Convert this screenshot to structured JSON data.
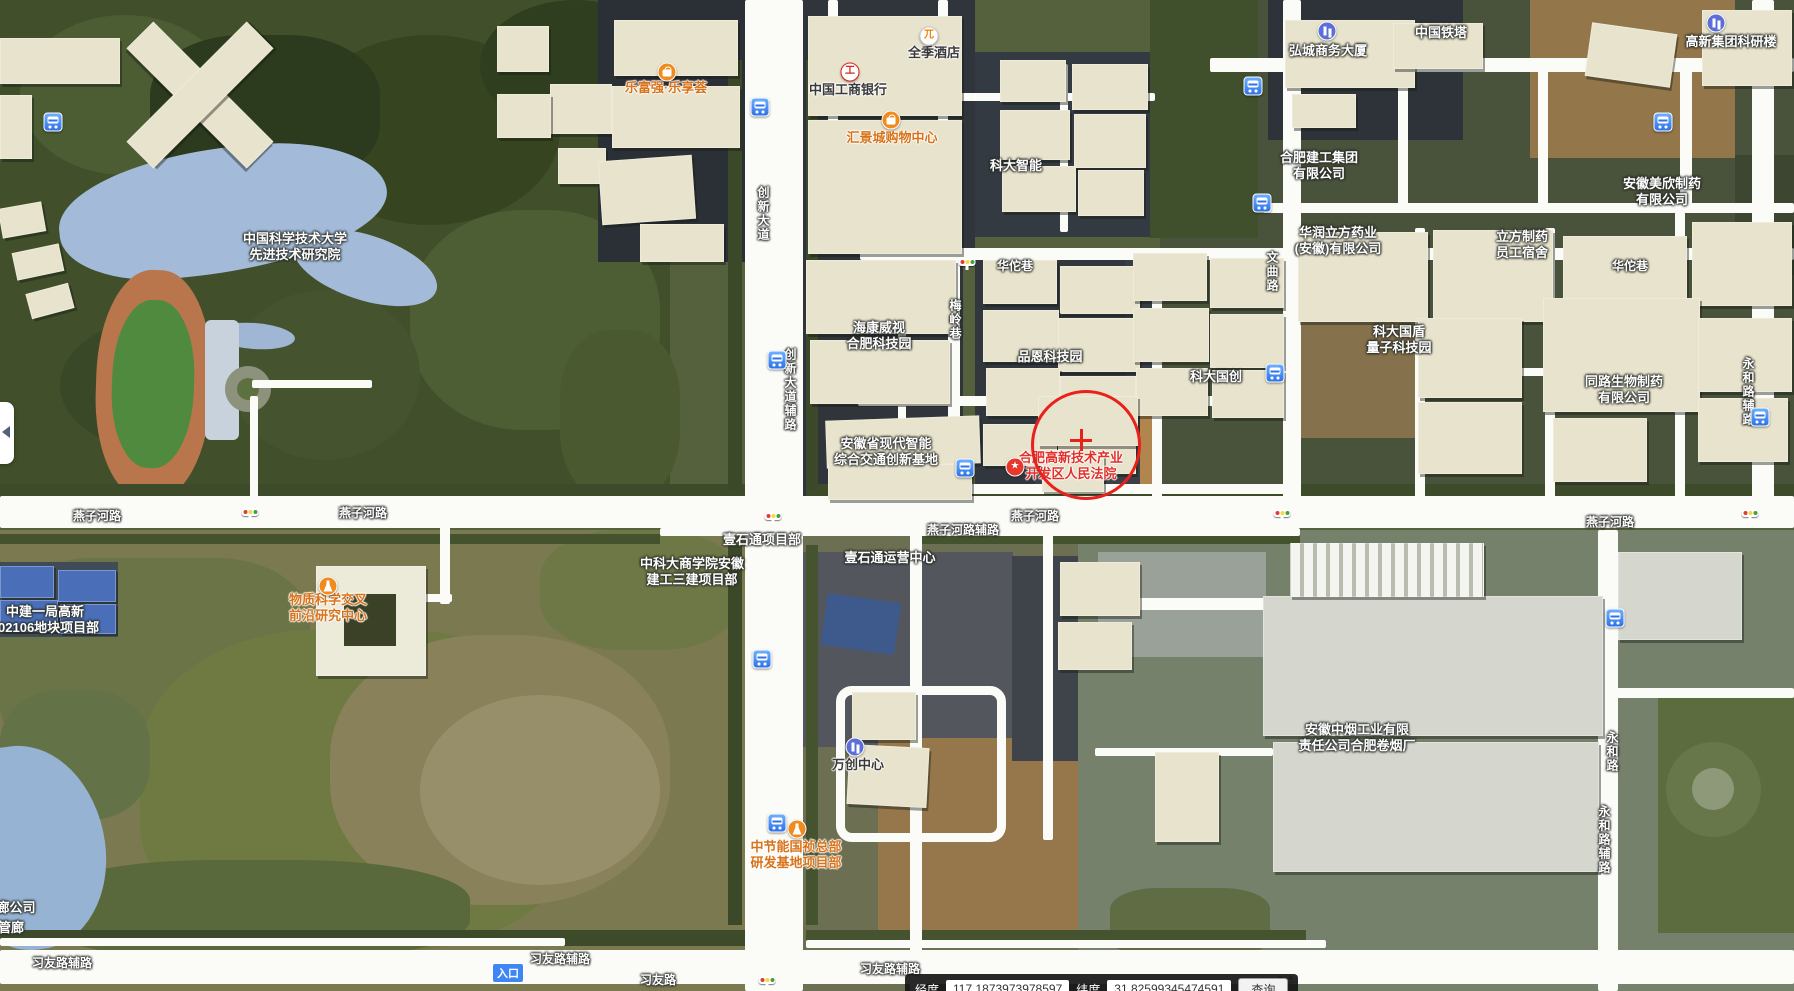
{
  "map": {
    "colors": {
      "poi_orange": "#d9731a",
      "poi_red": "#e0312b",
      "poi_dark": "#3a3a3a",
      "road_label_white": "#ffffff",
      "marker_red": "#e8211a",
      "entrance_blue": "#3f86f5"
    },
    "road_labels": [
      {
        "text": "燕子河路",
        "x": 97,
        "y": 516,
        "vertical": false
      },
      {
        "text": "燕子河路",
        "x": 363,
        "y": 513,
        "vertical": false
      },
      {
        "text": "燕子河路",
        "x": 1035,
        "y": 516,
        "vertical": false
      },
      {
        "text": "燕子河路",
        "x": 1610,
        "y": 522,
        "vertical": false
      },
      {
        "text": "燕子河路辅路",
        "x": 963,
        "y": 530,
        "vertical": false
      },
      {
        "text": "习友路辅路",
        "x": 62,
        "y": 963,
        "vertical": false
      },
      {
        "text": "习友路辅路",
        "x": 560,
        "y": 959,
        "vertical": false
      },
      {
        "text": "习友路辅路",
        "x": 890,
        "y": 969,
        "vertical": false
      },
      {
        "text": "习友路",
        "x": 658,
        "y": 980,
        "vertical": false
      },
      {
        "text": "创新大道",
        "x": 763,
        "y": 214,
        "vertical": true
      },
      {
        "text": "创新大道辅路",
        "x": 790,
        "y": 390,
        "vertical": true
      },
      {
        "text": "华佗巷",
        "x": 1015,
        "y": 266,
        "vertical": false
      },
      {
        "text": "华佗巷",
        "x": 1630,
        "y": 266,
        "vertical": false
      },
      {
        "text": "梅岭巷",
        "x": 955,
        "y": 320,
        "vertical": true
      },
      {
        "text": "文曲路",
        "x": 1272,
        "y": 272,
        "vertical": true
      },
      {
        "text": "永和路辅路",
        "x": 1748,
        "y": 392,
        "vertical": true
      },
      {
        "text": "永和路",
        "x": 1612,
        "y": 752,
        "vertical": true
      },
      {
        "text": "永和路辅路",
        "x": 1604,
        "y": 840,
        "vertical": true
      }
    ],
    "poi_labels": [
      {
        "lines": [
          "中国科学技术大学",
          "先进技术研究院"
        ],
        "x": 295,
        "y": 247,
        "color": "white"
      },
      {
        "lines": [
          "乐富强·乐享荟"
        ],
        "x": 666,
        "y": 88,
        "color": "orange",
        "icon": "bag",
        "icon_x": 667,
        "icon_y": 72
      },
      {
        "lines": [
          "中国工商银行"
        ],
        "x": 848,
        "y": 90,
        "color": "dark",
        "icon": "icbc",
        "icon_x": 850,
        "icon_y": 72
      },
      {
        "lines": [
          "全季酒店"
        ],
        "x": 934,
        "y": 53,
        "color": "dark",
        "icon": "hotel",
        "icon_x": 929,
        "icon_y": 36
      },
      {
        "lines": [
          "汇景城购物中心"
        ],
        "x": 892,
        "y": 138,
        "color": "orange",
        "icon": "bag",
        "icon_x": 891,
        "icon_y": 120
      },
      {
        "lines": [
          "科大智能"
        ],
        "x": 1016,
        "y": 166,
        "color": "white"
      },
      {
        "lines": [
          "弘城商务大厦"
        ],
        "x": 1328,
        "y": 51,
        "color": "white",
        "icon": "building",
        "icon_x": 1327,
        "icon_y": 31
      },
      {
        "lines": [
          "中国铁塔"
        ],
        "x": 1441,
        "y": 33,
        "color": "white"
      },
      {
        "lines": [
          "高新集团科研楼"
        ],
        "x": 1731,
        "y": 42,
        "color": "white",
        "icon": "building",
        "icon_x": 1716,
        "icon_y": 23
      },
      {
        "lines": [
          "合肥建工集团",
          "有限公司"
        ],
        "x": 1319,
        "y": 166,
        "color": "white"
      },
      {
        "lines": [
          "华润立方药业",
          "(安徽)有限公司"
        ],
        "x": 1338,
        "y": 241,
        "color": "white"
      },
      {
        "lines": [
          "立方制药",
          "员工宿舍"
        ],
        "x": 1522,
        "y": 245,
        "color": "white"
      },
      {
        "lines": [
          "安徽美欣制药",
          "有限公司"
        ],
        "x": 1662,
        "y": 192,
        "color": "white"
      },
      {
        "lines": [
          "海康威视",
          "合肥科技园"
        ],
        "x": 879,
        "y": 336,
        "color": "white"
      },
      {
        "lines": [
          "品恩科技园"
        ],
        "x": 1050,
        "y": 357,
        "color": "white"
      },
      {
        "lines": [
          "科大国创"
        ],
        "x": 1216,
        "y": 377,
        "color": "white"
      },
      {
        "lines": [
          "科大国盾",
          "量子科技园"
        ],
        "x": 1399,
        "y": 340,
        "color": "white"
      },
      {
        "lines": [
          "同路生物制药",
          "有限公司"
        ],
        "x": 1624,
        "y": 390,
        "color": "white"
      },
      {
        "lines": [
          "安徽省现代智能",
          "综合交通创新基地"
        ],
        "x": 886,
        "y": 452,
        "color": "white"
      },
      {
        "lines": [
          "合肥高新技术产业",
          "开发区人民法院"
        ],
        "x": 1071,
        "y": 466,
        "color": "red",
        "icon": "star",
        "icon_x": 1015,
        "icon_y": 467
      },
      {
        "lines": [
          "物质科学交叉",
          "前沿研究中心"
        ],
        "x": 328,
        "y": 608,
        "color": "orange",
        "icon": "flask",
        "icon_x": 328,
        "icon_y": 586
      },
      {
        "lines": [
          "中建一局高新",
          "202106地块项目部"
        ],
        "x": 45,
        "y": 620,
        "color": "white"
      },
      {
        "lines": [
          "中科大商学院安徽",
          "建工三建项目部"
        ],
        "x": 692,
        "y": 572,
        "color": "white"
      },
      {
        "lines": [
          "壹石通项目部"
        ],
        "x": 762,
        "y": 540,
        "color": "white"
      },
      {
        "lines": [
          "壹石通运营中心"
        ],
        "x": 890,
        "y": 558,
        "color": "white"
      },
      {
        "lines": [
          "万创中心"
        ],
        "x": 858,
        "y": 765,
        "color": "dark",
        "icon": "building",
        "icon_x": 855,
        "icon_y": 747
      },
      {
        "lines": [
          "中节能国祯总部",
          "研发基地项目部"
        ],
        "x": 796,
        "y": 855,
        "color": "orange",
        "icon": "flask",
        "icon_x": 797,
        "icon_y": 829
      },
      {
        "lines": [
          "安徽中烟工业有限",
          "责任公司合肥卷烟厂"
        ],
        "x": 1357,
        "y": 738,
        "color": "white"
      },
      {
        "lines": [
          "廊公司"
        ],
        "x": 16,
        "y": 908,
        "color": "white"
      },
      {
        "lines": [
          "管廊"
        ],
        "x": 11,
        "y": 928,
        "color": "white"
      }
    ],
    "bus_stops": [
      {
        "x": 53,
        "y": 122
      },
      {
        "x": 760,
        "y": 107
      },
      {
        "x": 777,
        "y": 360
      },
      {
        "x": 965,
        "y": 468
      },
      {
        "x": 762,
        "y": 659
      },
      {
        "x": 777,
        "y": 823
      },
      {
        "x": 1253,
        "y": 86
      },
      {
        "x": 1262,
        "y": 203
      },
      {
        "x": 1275,
        "y": 373
      },
      {
        "x": 1663,
        "y": 122
      },
      {
        "x": 1615,
        "y": 618
      },
      {
        "x": 1760,
        "y": 417
      }
    ],
    "traffic_lights": [
      {
        "x": 967,
        "y": 262
      },
      {
        "x": 250,
        "y": 512
      },
      {
        "x": 773,
        "y": 516
      },
      {
        "x": 1282,
        "y": 513
      },
      {
        "x": 1750,
        "y": 513
      },
      {
        "x": 767,
        "y": 980
      },
      {
        "x": 1285,
        "y": 978
      }
    ],
    "marker": {
      "x": 1083,
      "y": 442,
      "r": 52,
      "cross_x": 1081,
      "cross_y": 440
    },
    "entrance": {
      "text": "入口",
      "x": 508,
      "y": 973
    },
    "coordinate_bar": {
      "lon_label": "经度",
      "lon_value": "117.1873973978597",
      "lat_label": "纬度",
      "lat_value": "31.82599345474591",
      "button_label": "查询"
    }
  }
}
